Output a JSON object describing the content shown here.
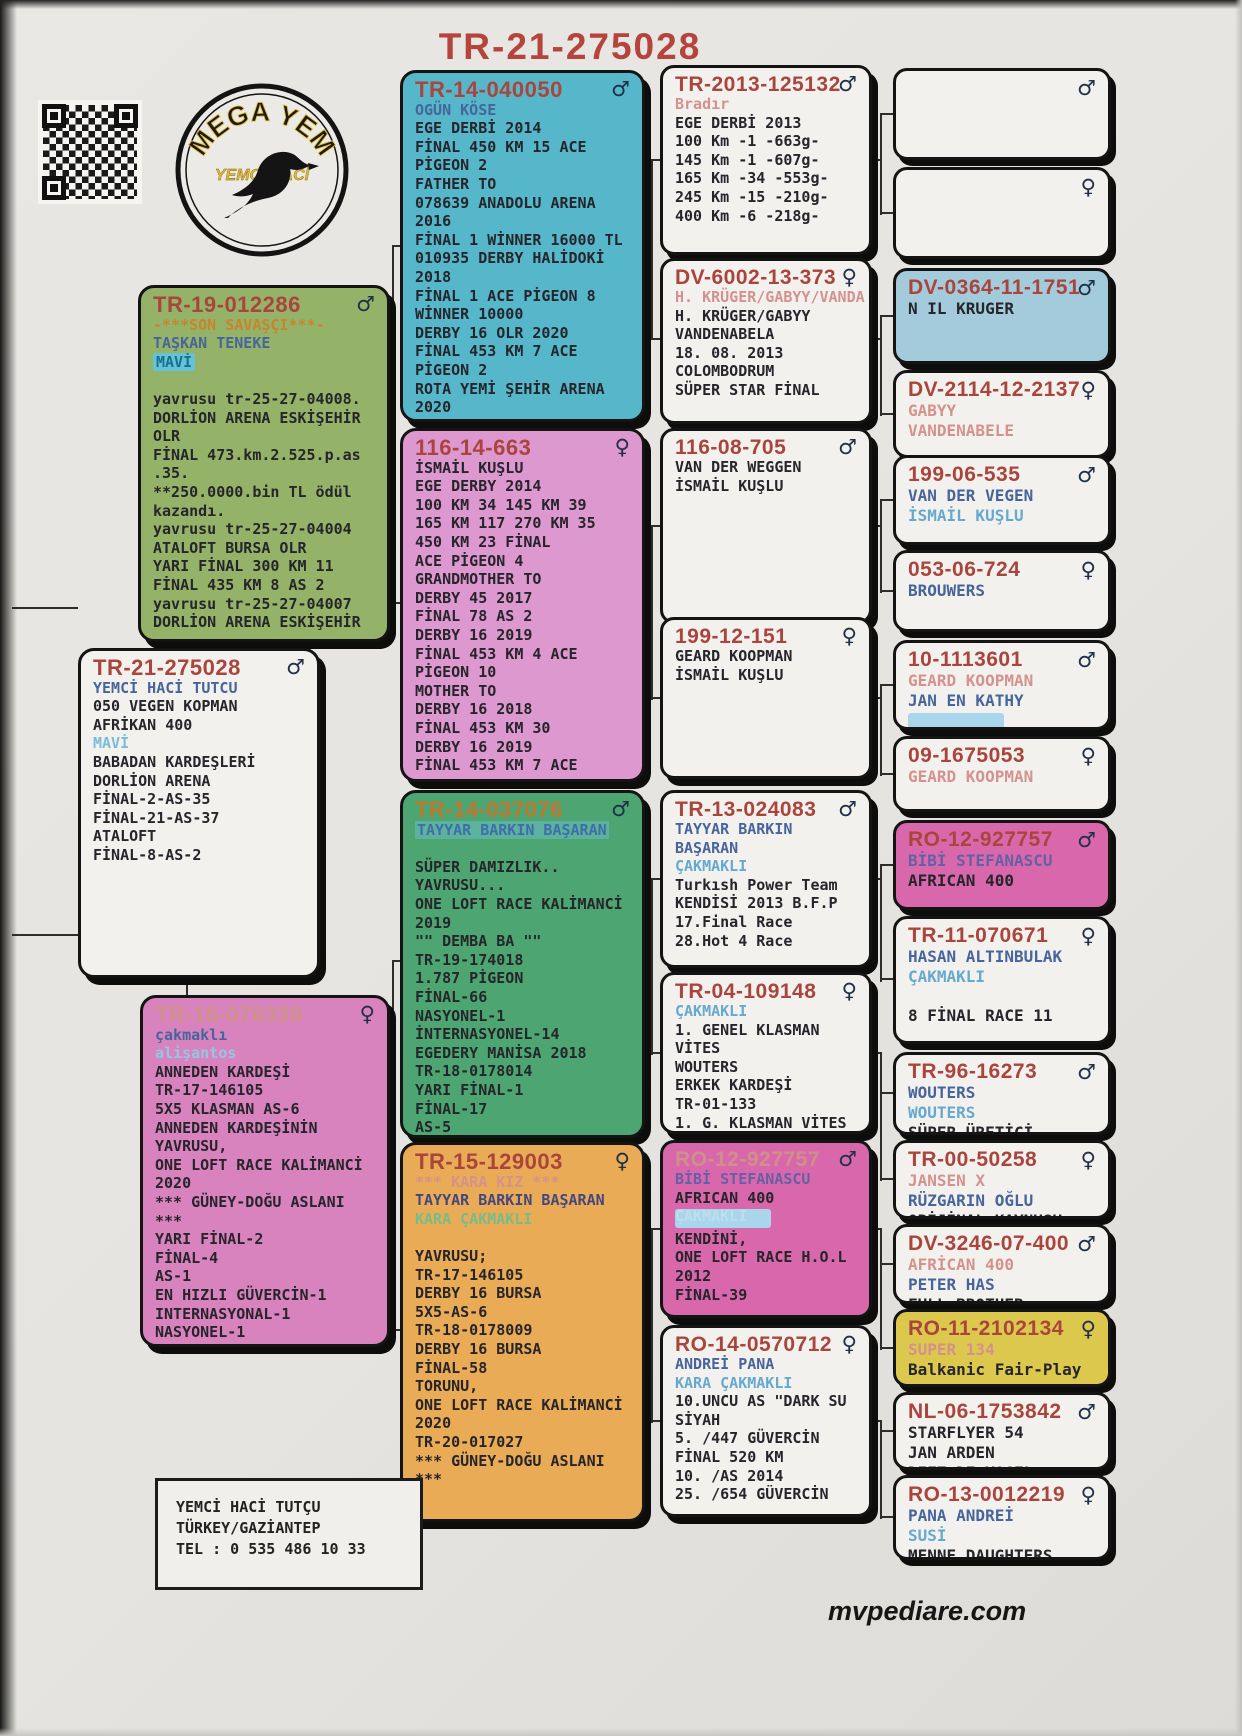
{
  "title": "TR-21-275028",
  "footer": "mvpediare.com",
  "logo": {
    "top": "MEGA YEM",
    "sub": "YEMCİ HACİ"
  },
  "contact": {
    "lines": [
      "YEMCİ HACİ TUTÇU",
      "TÜRKEY/GAZİANTEP",
      "TEL : 0 535 486 10 33"
    ]
  },
  "colors": {
    "title_red": "#b4443c",
    "id_red": "#a9453d",
    "name_blue": "#47659b",
    "name_lightblue": "#66a9cf",
    "paper": "#e7e5e2"
  },
  "boxes": [
    {
      "key": "tr19",
      "id": "TR-19-012286",
      "sex": "m",
      "bg": "#95b368",
      "lines": [
        [
          "accent",
          "-***SON SAVAŞÇI***-"
        ],
        [
          "name",
          "TAŞKAN TENEKE"
        ],
        [
          "hl",
          "MAVİ"
        ],
        [
          "blank",
          ""
        ],
        [
          "body",
          "yavrusu tr-25-27-04008."
        ],
        [
          "body",
          "DORLİON ARENA ESKİŞEHİR"
        ],
        [
          "body",
          "OLR"
        ],
        [
          "body",
          "FİNAL 473.km.2.525.p.as"
        ],
        [
          "body",
          ".35."
        ],
        [
          "body",
          "**250.0000.bin TL ödül"
        ],
        [
          "body",
          "kazandı."
        ],
        [
          "body",
          "yavrusu tr-25-27-04004"
        ],
        [
          "body",
          "ATALOFT BURSA OLR"
        ],
        [
          "body",
          "YARI FİNAL 300 KM 11"
        ],
        [
          "body",
          "FİNAL 435 KM 8 AS 2"
        ],
        [
          "body",
          "yavrusu tr-25-27-04007"
        ],
        [
          "body",
          "DORLİON ARENA ESKİŞEHİR"
        ]
      ]
    },
    {
      "key": "main",
      "id": "TR-21-275028",
      "sex": "m",
      "bg": "#f3f1ee",
      "lines": [
        [
          "name",
          "YEMCİ HACİ TUTCU"
        ],
        [
          "body",
          "050 VEGEN KOPMAN"
        ],
        [
          "body",
          "AFRİKAN 400"
        ],
        [
          "mavi",
          "MAVİ"
        ],
        [
          "body",
          "BABADAN KARDEŞLERİ"
        ],
        [
          "body",
          "DORLİON ARENA"
        ],
        [
          "body",
          "FİNAL-2-AS-35"
        ],
        [
          "body",
          "FİNAL-21-AS-37"
        ],
        [
          "body",
          "ATALOFT"
        ],
        [
          "body",
          "FİNAL-8-AS-2"
        ]
      ]
    },
    {
      "key": "tr16",
      "id": "TR-16-076339",
      "idStyle": "faded",
      "sex": "f",
      "bg": "#d883bd",
      "lines": [
        [
          "name",
          "çakmaklı"
        ],
        [
          "name2f",
          "alişantos"
        ],
        [
          "body",
          "ANNEDEN KARDEŞİ"
        ],
        [
          "body",
          "TR-17-146105"
        ],
        [
          "body",
          "5X5 KLASMAN AS-6"
        ],
        [
          "body",
          "ANNEDEN KARDEŞİNİN"
        ],
        [
          "body",
          "YAVRUSU,"
        ],
        [
          "body",
          "ONE LOFT RACE KALİMANCİ"
        ],
        [
          "body",
          "2020"
        ],
        [
          "body",
          "*** GÜNEY-DOĞU ASLANI"
        ],
        [
          "body",
          "***"
        ],
        [
          "body",
          "YARI FİNAL-2"
        ],
        [
          "body",
          "FİNAL-4"
        ],
        [
          "body",
          "AS-1"
        ],
        [
          "body",
          "EN HIZLI GÜVERCİN-1"
        ],
        [
          "body",
          "INTERNASYONAL-1"
        ],
        [
          "body",
          "NASYONEL-1"
        ]
      ]
    },
    {
      "key": "tr14040050",
      "id": "TR-14-040050",
      "sex": "m",
      "bg": "#55b7c9",
      "lines": [
        [
          "name",
          "OGÜN KÖSE"
        ],
        [
          "body",
          "EGE DERBİ 2014"
        ],
        [
          "body",
          "FİNAL 450 KM 15 ACE"
        ],
        [
          "body",
          "PİGEON 2"
        ],
        [
          "body",
          "FATHER TO"
        ],
        [
          "body",
          "078639 ANADOLU ARENA"
        ],
        [
          "body",
          "2016"
        ],
        [
          "body",
          "FİNAL 1 WİNNER 16000 TL"
        ],
        [
          "body",
          "010935 DERBY HALİDOKİ"
        ],
        [
          "body",
          "2018"
        ],
        [
          "body",
          "FİNAL 1 ACE PİGEON 8"
        ],
        [
          "body",
          "WİNNER 10000"
        ],
        [
          "body",
          "DERBY 16 OLR 2020"
        ],
        [
          "body",
          "FİNAL 453 KM 7 ACE"
        ],
        [
          "body",
          "PİGEON 2"
        ],
        [
          "body",
          "ROTA YEMİ ŞEHİR ARENA"
        ],
        [
          "body",
          "2020"
        ]
      ]
    },
    {
      "key": "b116_14_663",
      "id": "116-14-663",
      "sex": "f",
      "bg": "#dd98cf",
      "lines": [
        [
          "body",
          "İSMAİL KUŞLU"
        ],
        [
          "body",
          "EGE DERBY 2014"
        ],
        [
          "body",
          "100 KM 34 145 KM 39"
        ],
        [
          "body",
          "165 KM 117 270 KM 35"
        ],
        [
          "body",
          "450 KM 23 FİNAL"
        ],
        [
          "body",
          "ACE PİGEON 4"
        ],
        [
          "body",
          "GRANDMOTHER TO"
        ],
        [
          "body",
          "DERBY 45 2017"
        ],
        [
          "body",
          "FİNAL 78 AS 2"
        ],
        [
          "body",
          "DERBY 16 2019"
        ],
        [
          "body",
          "FİNAL 453 KM 4 ACE"
        ],
        [
          "body",
          "PİGEON 10"
        ],
        [
          "body",
          "MOTHER TO"
        ],
        [
          "body",
          "DERBY 16 2018"
        ],
        [
          "body",
          "FİNAL 453 KM 30"
        ],
        [
          "body",
          "DERBY 16 2019"
        ],
        [
          "body",
          "FİNAL 453 KM 7 ACE"
        ]
      ]
    },
    {
      "key": "tr14037076",
      "id": "TR-14-037076",
      "idStyle": "orange",
      "sex": "m",
      "bg": "#4da671",
      "lines": [
        [
          "namehl",
          "TAYYAR BARKIN BAŞARAN"
        ],
        [
          "blank",
          ""
        ],
        [
          "body",
          "SÜPER DAMIZLIK.."
        ],
        [
          "body",
          "YAVRUSU..."
        ],
        [
          "body",
          "ONE LOFT RACE KALİMANCİ"
        ],
        [
          "body",
          "2019"
        ],
        [
          "body",
          "\"\" DEMBA BA \"\""
        ],
        [
          "body",
          "TR-19-174018"
        ],
        [
          "body",
          "1.787 PİGEON"
        ],
        [
          "body",
          "FİNAL-66"
        ],
        [
          "body",
          "NASYONEL-1"
        ],
        [
          "body",
          "İNTERNASYONEL-14"
        ],
        [
          "body",
          "EGEDERY MANİSA 2018"
        ],
        [
          "body",
          "TR-18-0178014"
        ],
        [
          "body",
          "YARI FİNAL-1"
        ],
        [
          "body",
          "FİNAL-17"
        ],
        [
          "body",
          "AS-5"
        ]
      ]
    },
    {
      "key": "tr15129003",
      "id": "TR-15-129003",
      "sex": "f",
      "bg": "#e9ab55",
      "lines": [
        [
          "fadedpink",
          "*** KARA KIZ ***"
        ],
        [
          "navy",
          "TAYYAR BARKIN BAŞARAN"
        ],
        [
          "greenf",
          "KARA ÇAKMAKLI"
        ],
        [
          "blank",
          ""
        ],
        [
          "body",
          "YAVRUSU;"
        ],
        [
          "body",
          "TR-17-146105"
        ],
        [
          "body",
          "DERBY 16 BURSA"
        ],
        [
          "body",
          "5X5-AS-6"
        ],
        [
          "body",
          "TR-18-0178009"
        ],
        [
          "body",
          "DERBY 16 BURSA"
        ],
        [
          "body",
          "FİNAL-58"
        ],
        [
          "body",
          "TORUNU,"
        ],
        [
          "body",
          "ONE LOFT RACE KALİMANCİ"
        ],
        [
          "body",
          "2020"
        ],
        [
          "body",
          "TR-20-017027"
        ],
        [
          "body",
          "*** GÜNEY-DOĞU ASLANI"
        ],
        [
          "body",
          "***"
        ]
      ]
    },
    {
      "key": "tr2013",
      "id": "TR-2013-125132",
      "sex": "m",
      "bg": "#f3f1ee",
      "lines": [
        [
          "fadedpink",
          "Bradır"
        ],
        [
          "body",
          "EGE DERBİ 2013"
        ],
        [
          "body",
          "100 Km -1 -663g-"
        ],
        [
          "body",
          "145 Km -1 -607g-"
        ],
        [
          "body",
          "165 Km -34 -553g-"
        ],
        [
          "body",
          "245 Km -15 -210g-"
        ],
        [
          "body",
          "400 Km -6 -218g-"
        ]
      ]
    },
    {
      "key": "dv6002",
      "id": "DV-6002-13-373",
      "sex": "f",
      "bg": "#f3f1ee",
      "lines": [
        [
          "fadedpink",
          "H. KRÜGER/GABYY/VANDA"
        ],
        [
          "body",
          "H. KRÜGER/GABYY"
        ],
        [
          "body",
          "VANDENABELA"
        ],
        [
          "body",
          "18. 08. 2013"
        ],
        [
          "body",
          "COLOMBODRUM"
        ],
        [
          "body",
          "SÜPER STAR FİNAL"
        ]
      ]
    },
    {
      "key": "b116_08_705",
      "id": "116-08-705",
      "sex": "m",
      "bg": "#f3f1ee",
      "lines": [
        [
          "body",
          "VAN DER WEGGEN"
        ],
        [
          "body",
          "İSMAİL KUŞLU"
        ]
      ]
    },
    {
      "key": "b199_12_151",
      "id": "199-12-151",
      "sex": "f",
      "bg": "#f3f1ee",
      "lines": [
        [
          "body",
          "GEARD KOOPMAN"
        ],
        [
          "body",
          "İSMAİL KUŞLU"
        ]
      ]
    },
    {
      "key": "tr13",
      "id": "TR-13-024083",
      "sex": "m",
      "bg": "#f3f1ee",
      "lines": [
        [
          "name",
          "TAYYAR BARKIN"
        ],
        [
          "name",
          "BAŞARAN"
        ],
        [
          "name2",
          "ÇAKMAKLI"
        ],
        [
          "body",
          "Turkısh Power Team"
        ],
        [
          "body",
          "KENDİSİ 2013 B.F.P"
        ],
        [
          "body",
          "17.Final Race"
        ],
        [
          "body",
          "28.Hot 4 Race"
        ]
      ]
    },
    {
      "key": "tr04",
      "id": "TR-04-109148",
      "sex": "f",
      "bg": "#f3f1ee",
      "lines": [
        [
          "name2",
          "ÇAKMAKLI"
        ],
        [
          "body",
          "1. GENEL KLASMAN"
        ],
        [
          "body",
          "VİTES"
        ],
        [
          "body",
          "WOUTERS"
        ],
        [
          "body",
          "ERKEK KARDEŞİ"
        ],
        [
          "body",
          "TR-01-133"
        ],
        [
          "body",
          "1. G. KLASMAN VİTES"
        ],
        [
          "cut",
          "2022"
        ]
      ]
    },
    {
      "key": "ro12_big",
      "id": "RO-12-927757",
      "idStyle": "faded",
      "sex": "m",
      "bg": "#d868ab",
      "lines": [
        [
          "purple",
          "BİBİ STEFANASCU"
        ],
        [
          "body",
          "AFRICAN 400"
        ],
        [
          "smudge",
          "ÇAKMAKLI"
        ],
        [
          "body",
          "KENDİNİ,"
        ],
        [
          "body",
          "ONE LOFT RACE H.O.L"
        ],
        [
          "body",
          "2012"
        ],
        [
          "body",
          "FİNAL-39"
        ]
      ]
    },
    {
      "key": "ro14",
      "id": "RO-14-0570712",
      "sex": "f",
      "bg": "#f3f1ee",
      "lines": [
        [
          "name",
          "ANDREİ PANA"
        ],
        [
          "name2",
          "KARA ÇAKMAKLI"
        ],
        [
          "body",
          "10.UNCU AS \"DARK SU"
        ],
        [
          "body",
          "SİYAH"
        ],
        [
          "body",
          "5. /447 GÜVERCİN"
        ],
        [
          "body",
          "FİNAL 520 KM"
        ],
        [
          "body",
          "10. /AS 2014"
        ],
        [
          "cut",
          "25. /654 GÜVERCİN"
        ]
      ]
    },
    {
      "key": "empty_m",
      "id": "",
      "sex": "m",
      "bg": "#f3f1ee",
      "lines": []
    },
    {
      "key": "empty_f",
      "id": "",
      "sex": "f",
      "bg": "#f3f1ee",
      "lines": []
    },
    {
      "key": "dv0364",
      "id": "DV-0364-11-1751",
      "sex": "m",
      "bg": "#a3cbdc",
      "lines": [
        [
          "body",
          "N IL KRUGER"
        ]
      ]
    },
    {
      "key": "dv2114",
      "id": "DV-2114-12-2137",
      "sex": "f",
      "bg": "#f3f1ee",
      "lines": [
        [
          "fadedpink",
          "GABYY"
        ],
        [
          "fadedpink",
          "VANDENABELE"
        ]
      ]
    },
    {
      "key": "b199_06_535",
      "id": "199-06-535",
      "sex": "m",
      "bg": "#f3f1ee",
      "lines": [
        [
          "name",
          "VAN DER VEGEN"
        ],
        [
          "name2",
          "İSMAİL KUŞLU"
        ]
      ]
    },
    {
      "key": "b053_06_724",
      "id": "053-06-724",
      "sex": "f",
      "bg": "#f3f1ee",
      "lines": [
        [
          "name",
          "BROUWERS"
        ]
      ]
    },
    {
      "key": "b10_1113601",
      "id": "10-1113601",
      "sex": "m",
      "bg": "#f3f1ee",
      "lines": [
        [
          "fadedpink",
          "GEARD KOOPMAN"
        ],
        [
          "name",
          "JAN EN KATHY"
        ],
        [
          "smudge",
          " "
        ]
      ]
    },
    {
      "key": "b09_1675053",
      "id": "09-1675053",
      "sex": "f",
      "bg": "#f3f1ee",
      "lines": [
        [
          "fadedpink",
          "GEARD KOOPMAN"
        ]
      ]
    },
    {
      "key": "ro12_small",
      "id": "RO-12-927757",
      "sex": "m",
      "bg": "#d868ab",
      "lines": [
        [
          "purple",
          "BİBİ STEFANASCU"
        ],
        [
          "body",
          "AFRICAN 400"
        ]
      ]
    },
    {
      "key": "tr11",
      "id": "TR-11-070671",
      "sex": "f",
      "bg": "#f3f1ee",
      "lines": [
        [
          "name",
          "HASAN ALTINBULAK"
        ],
        [
          "name2",
          "ÇAKMAKLI"
        ],
        [
          "blank",
          ""
        ],
        [
          "cut",
          "8 FİNAL RACE 11"
        ]
      ]
    },
    {
      "key": "tr96",
      "id": "TR-96-16273",
      "sex": "m",
      "bg": "#f3f1ee",
      "lines": [
        [
          "name",
          "WOUTERS"
        ],
        [
          "name2",
          "WOUTERS"
        ],
        [
          "cut",
          "SÜPER ÜRETİCİ"
        ]
      ]
    },
    {
      "key": "tr00",
      "id": "TR-00-50258",
      "sex": "f",
      "bg": "#f3f1ee",
      "lines": [
        [
          "fadedpink",
          "JANSEN X"
        ],
        [
          "name",
          "RÜZGARIN OĞLU"
        ],
        [
          "cut",
          "ORİJİNAL KAYNUSU"
        ]
      ]
    },
    {
      "key": "dv3246",
      "id": "DV-3246-07-400",
      "sex": "m",
      "bg": "#f3f1ee",
      "lines": [
        [
          "fadedpink",
          "AFRİCAN 400"
        ],
        [
          "name",
          "PETER HAS"
        ],
        [
          "cut",
          "FULL BROTHER"
        ]
      ]
    },
    {
      "key": "ro11",
      "id": "RO-11-2102134",
      "sex": "f",
      "bg": "#ddc84e",
      "lines": [
        [
          "fadedpink",
          "SUPER 134"
        ],
        [
          "body",
          "Balkanic Fair-Play"
        ]
      ]
    },
    {
      "key": "nl06",
      "id": "NL-06-1753842",
      "sex": "m",
      "bg": "#f3f1ee",
      "lines": [
        [
          "body",
          "STARFLYER 54"
        ],
        [
          "body",
          "JAN ARDEN"
        ],
        [
          "cut",
          "DIET DE VOGEL"
        ]
      ]
    },
    {
      "key": "ro13",
      "id": "RO-13-0012219",
      "sex": "f",
      "bg": "#f3f1ee",
      "lines": [
        [
          "name",
          "PANA ANDREİ"
        ],
        [
          "name2",
          "SUSİ"
        ],
        [
          "cut",
          "MENNE DAUGHTERS"
        ]
      ]
    }
  ]
}
